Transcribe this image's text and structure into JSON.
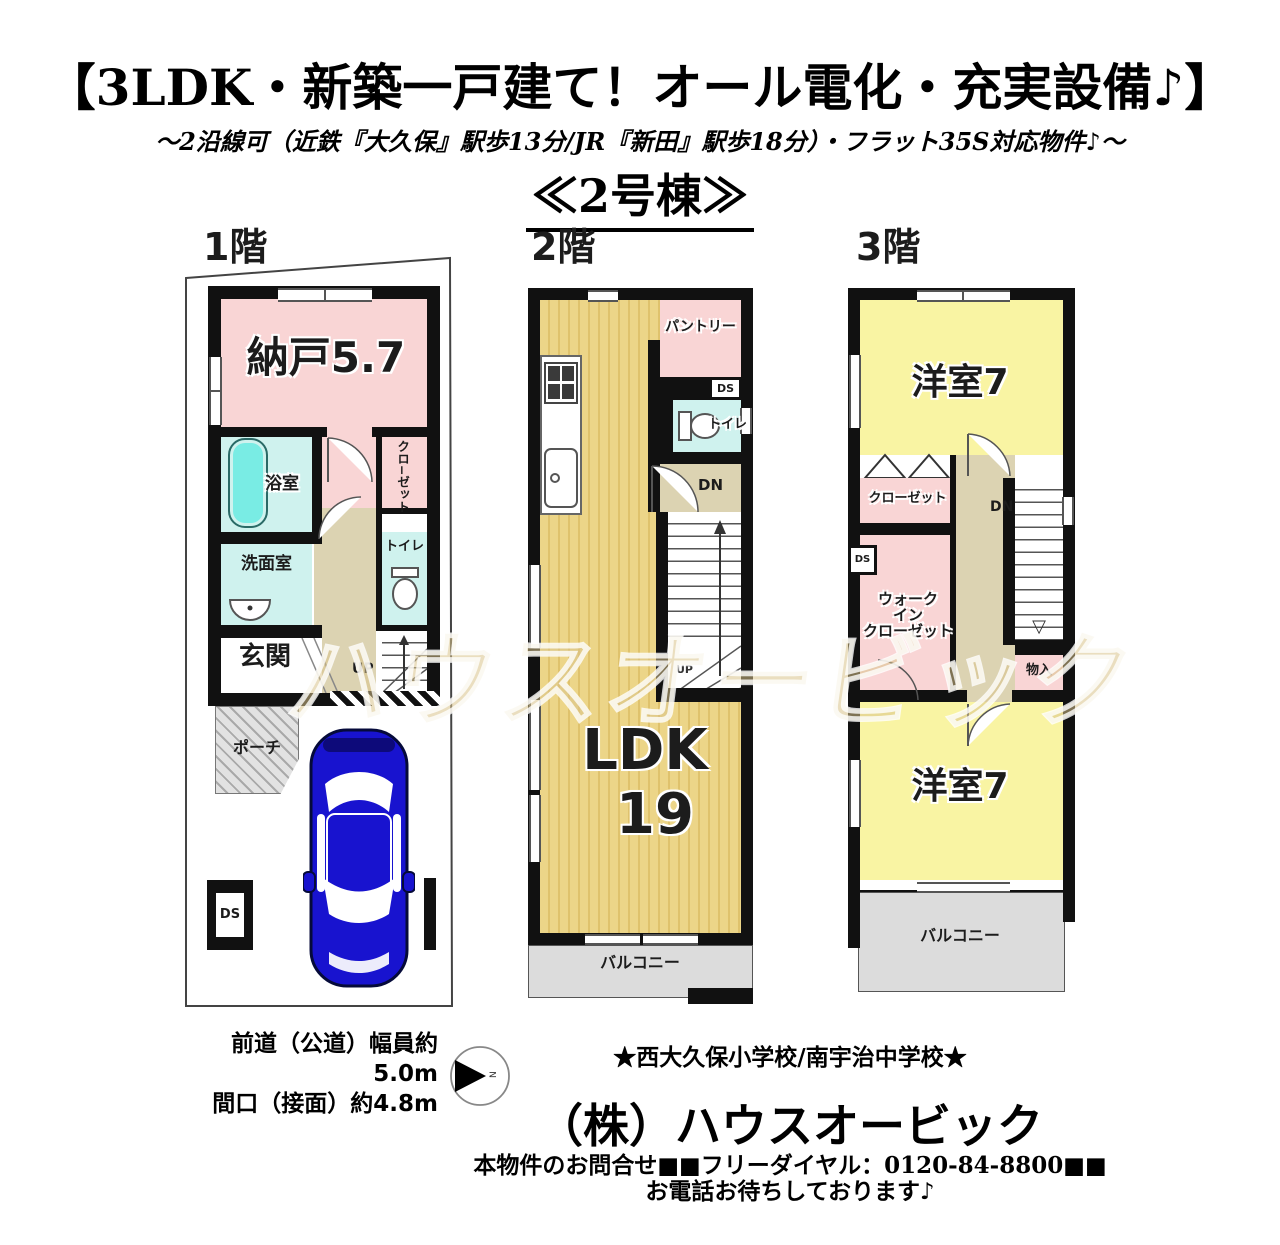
{
  "header": {
    "title": "【3LDK・新築一戸建て！オール電化・充実設備♪】",
    "subtitle": "～2沿線可（近鉄『大久保』駅歩13分/JR『新田』駅歩18分）・フラット35S対応物件♪～",
    "building": "≪2号棟≫"
  },
  "floor1": {
    "name": "1階",
    "nando": "納戸5.7",
    "bath": "浴室",
    "closet": "クロ−ゼット",
    "washroom": "洗面室",
    "toilet": "トイレ",
    "genkan": "玄関",
    "up": "UP",
    "porch": "ポーチ",
    "ds": "DS"
  },
  "floor2": {
    "name": "2階",
    "pantry": "パントリー",
    "ds": "DS",
    "toilet": "トイレ",
    "dn": "DN",
    "up": "UP",
    "ldk1": "LDK",
    "ldk2": "19",
    "balcony": "バルコニー"
  },
  "floor3": {
    "name": "3階",
    "bed_top": "洋室7",
    "closet": "クローゼット",
    "dn": "DN",
    "ds": "DS",
    "wic1": "ウォーク",
    "wic2": "イン",
    "wic3": "クローゼット",
    "monoire": "物入",
    "bed_bottom": "洋室7",
    "balcony": "バルコニー"
  },
  "footer": {
    "road1": "前道（公道）幅員約5.0m",
    "road2": "間口（接面）約4.8m",
    "schools": "★西大久保小学校/南宇治中学校★",
    "company": "（株）ハウスオービック",
    "contact": "本物件のお問合せ■■フリーダイヤル：0120-84-8800■■",
    "wait": "お電話お待ちしております♪"
  },
  "watermark": "ハウスオービック",
  "compass": {
    "n": "N"
  },
  "colors": {
    "room_pink": "#f9d5d5",
    "room_cyan": "#cff2ee",
    "room_yellow": "#f9f4a3",
    "ldk_gold": "#e9d186",
    "hall_beige": "#dcd3b2",
    "balcony_gray": "#dcdcdc",
    "wall_black": "#111111",
    "bathtub_cyan": "#79ece4",
    "car_blue": "#1813cf"
  }
}
